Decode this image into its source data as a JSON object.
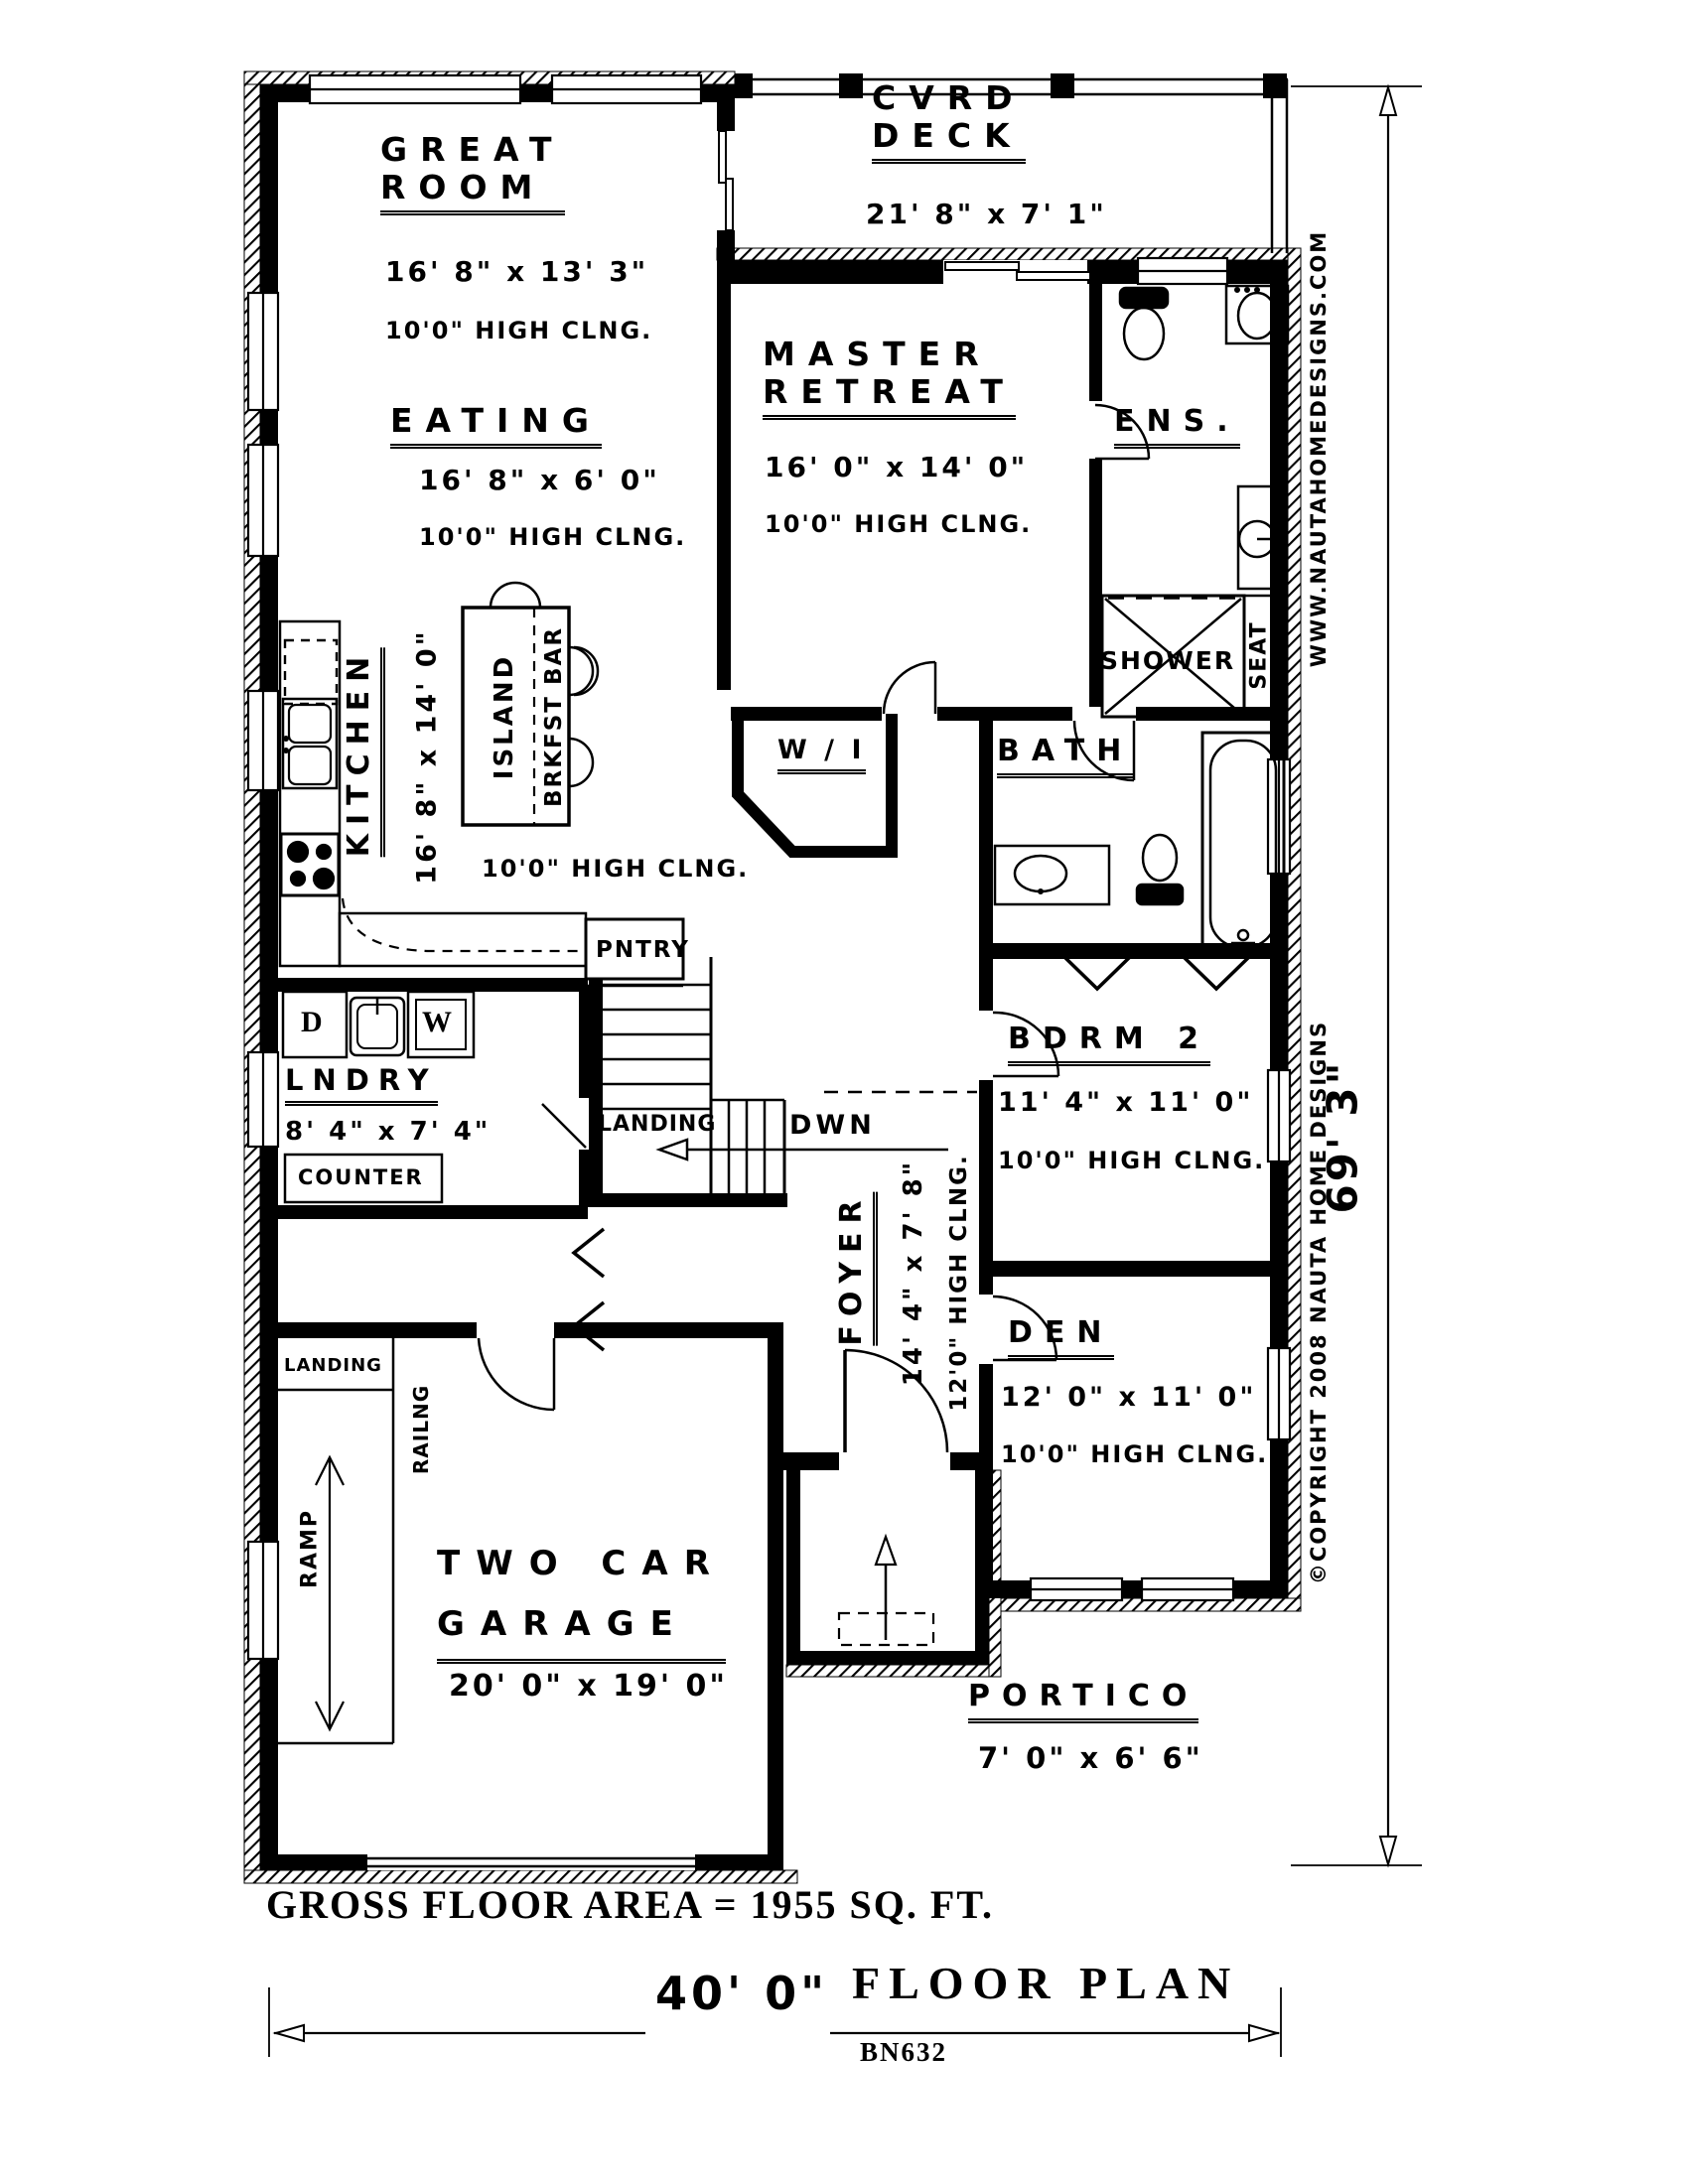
{
  "rooms": {
    "great_room": {
      "l1": "GREAT",
      "l2": "ROOM",
      "dims": "16' 8\" x 13' 3\"",
      "clng": "10'0\" HIGH CLNG."
    },
    "cvrd_deck": {
      "l1": "CVRD",
      "l2": "DECK",
      "dims": "21' 8\" x 7' 1\""
    },
    "master": {
      "l1": "MASTER",
      "l2": "RETREAT",
      "dims": "16' 0\" x 14' 0\"",
      "clng": "10'0\" HIGH CLNG."
    },
    "ens": {
      "label": "ENS."
    },
    "shower": {
      "label": "SHOWER",
      "seat": "SEAT"
    },
    "bath": {
      "label": "BATH"
    },
    "walkin": {
      "label": "W / I"
    },
    "eating": {
      "label": "EATING",
      "dims": "16' 8\" x 6' 0\"",
      "clng": "10'0\" HIGH CLNG."
    },
    "kitchen": {
      "label": "KITCHEN",
      "dims": "16' 8\" x 14' 0\"",
      "clng": "10'0\" HIGH CLNG.",
      "island": "ISLAND",
      "brkfst_bar": "BRKFST BAR",
      "pantry": "PNTRY"
    },
    "laundry": {
      "label": "LNDRY",
      "dims": "8' 4\" x 7' 4\"",
      "counter": "COUNTER",
      "dryer": "D",
      "washer": "W"
    },
    "stairs": {
      "landing": "LANDING",
      "down": "DWN"
    },
    "foyer": {
      "label": "FOYER",
      "dims": "14' 4\" x 7' 8\"",
      "clng": "12'0\" HIGH CLNG."
    },
    "bdrm2": {
      "label": "BDRM 2",
      "dims": "11' 4\" x 11' 0\"",
      "clng": "10'0\" HIGH CLNG."
    },
    "den": {
      "label": "DEN",
      "dims": "12' 0\" x 11' 0\"",
      "clng": "10'0\" HIGH CLNG."
    },
    "garage": {
      "l1": "TWO CAR",
      "l2": "GARAGE",
      "dims": "20' 0\" x 19' 0\"",
      "landing": "LANDING",
      "railing": "RAILNG",
      "ramp": "RAMP"
    },
    "portico": {
      "label": "PORTICO",
      "dims": "7' 0\" x 6' 6\""
    }
  },
  "footer": {
    "gross_area": "GROSS FLOOR AREA = 1955 SQ. FT.",
    "width_dim": "40' 0\"",
    "title": "FLOOR PLAN",
    "plan_number": "BN632"
  },
  "side": {
    "height_dim": "69' 3\"",
    "website": "WWW.NAUTAHOMEDESIGNS.COM",
    "copyright": "©COPYRIGHT 2008 NAUTA HOME DESIGNS"
  },
  "colors": {
    "ink": "#000000",
    "paper": "#ffffff"
  }
}
